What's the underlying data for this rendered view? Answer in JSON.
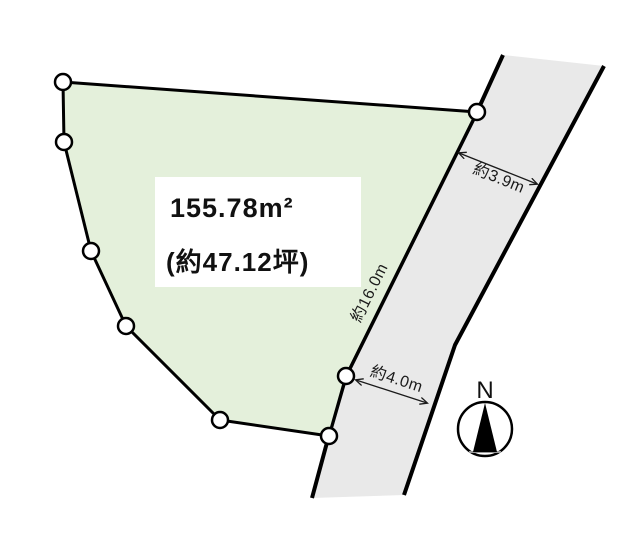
{
  "plot": {
    "area_sqm": "155.78m²",
    "area_tsubo": "(約47.12坪)"
  },
  "road": {
    "width_label_top": "約3.9m",
    "frontage_label": "約16.0m",
    "width_label_bottom": "約4.0m"
  },
  "compass": {
    "north_label": "N"
  },
  "colors": {
    "plot_fill": "#e4f0db",
    "road_fill": "#e9e9e9",
    "outline": "#000000",
    "background": "#ffffff"
  }
}
